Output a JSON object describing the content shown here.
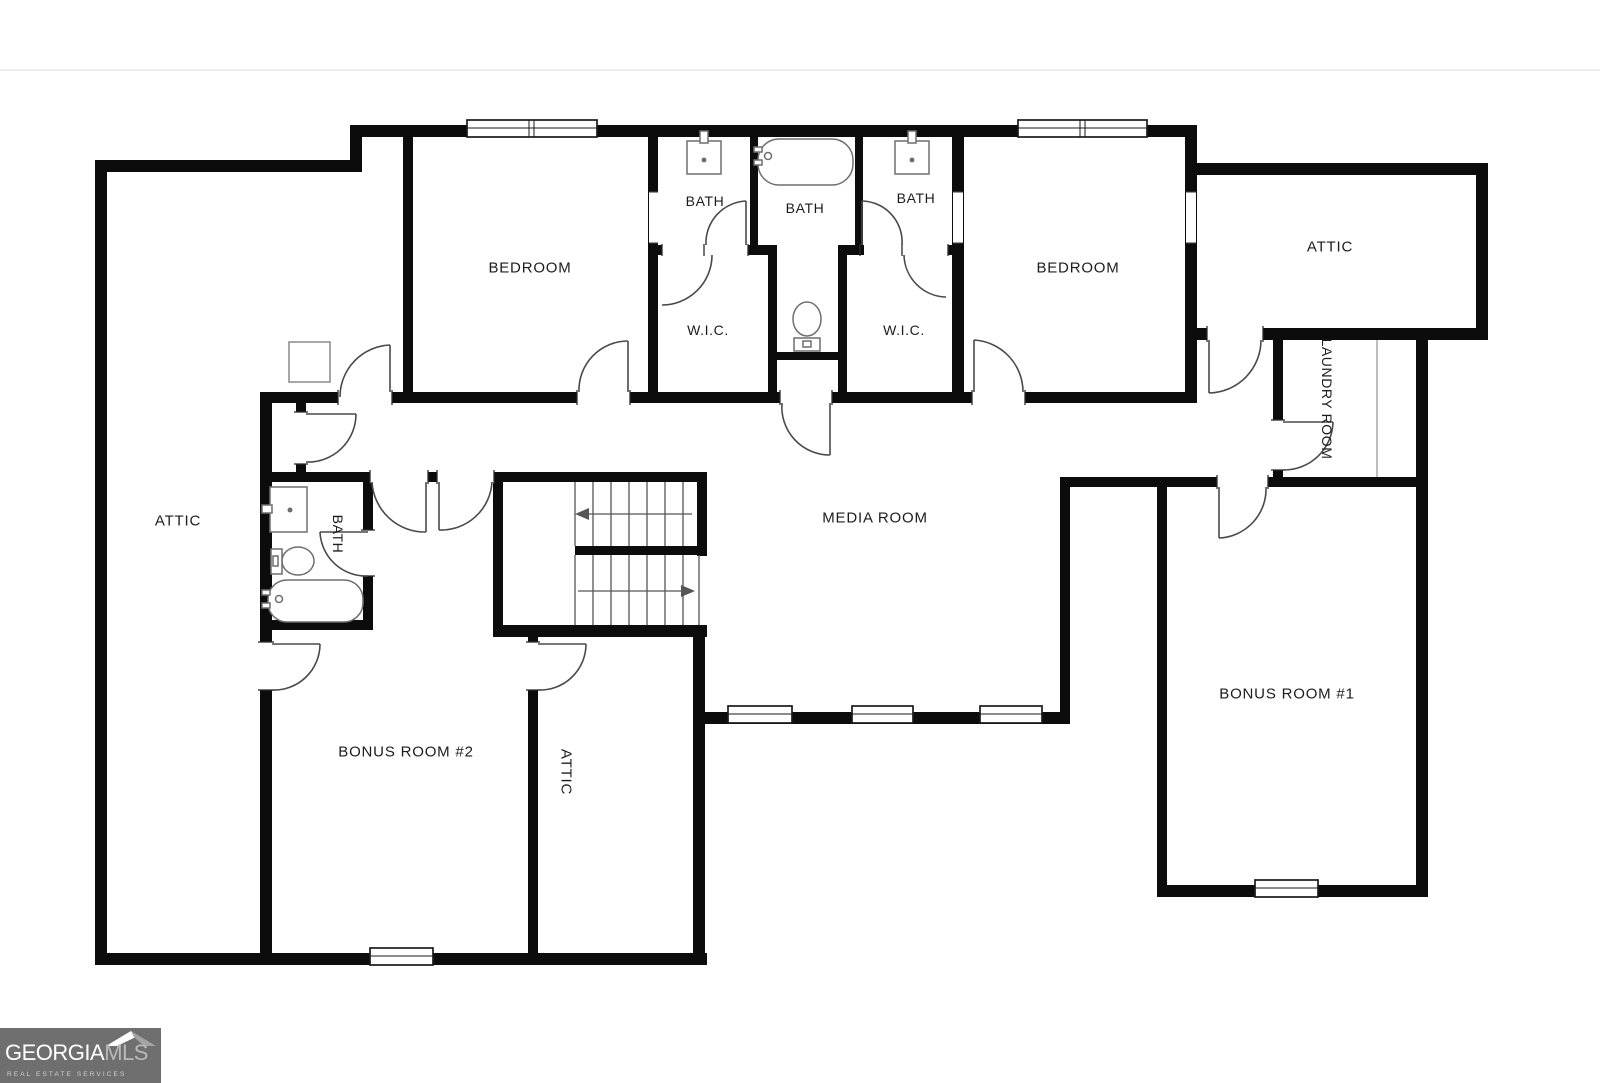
{
  "labels": {
    "bedroom_left": "BEDROOM",
    "bedroom_right": "BEDROOM",
    "bath_left": "BATH",
    "bath_middle": "BATH",
    "bath_right": "BATH",
    "bath_bottom": "BATH",
    "wic_left": "W.I.C.",
    "wic_right": "W.I.C.",
    "attic_left": "ATTIC",
    "attic_right": "ATTIC",
    "attic_bottom": "ATTIC",
    "laundry": "LAUNDRY ROOM",
    "media": "MEDIA ROOM",
    "bonus1": "BONUS ROOM #1",
    "bonus2": "BONUS ROOM #2"
  },
  "logo": {
    "brand_primary": "GEORGIA",
    "brand_secondary": "MLS",
    "tagline": "REAL ESTATE SERVICES"
  },
  "colors": {
    "wall": "#0c0c0c",
    "door_line": "#4a4a4a",
    "fixture_line": "#6e6e6e",
    "logo_bg": "#6f6f6f",
    "separator": "#ececec"
  }
}
